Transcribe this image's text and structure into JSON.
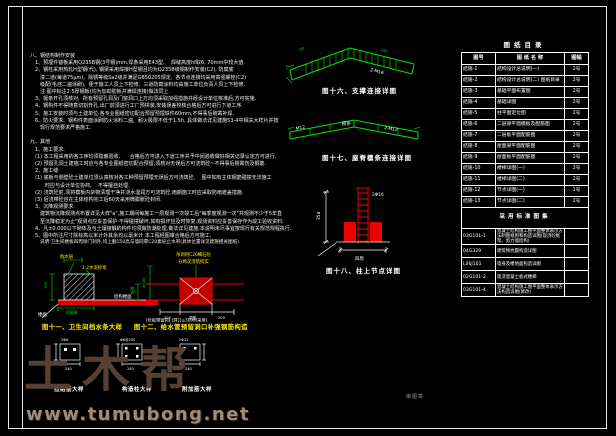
{
  "watermark": {
    "brand": "土木帮",
    "url": "www.tumubong.net"
  },
  "notes": {
    "lines": [
      "八、钢结构制作安装",
      "　1、预埋件锚板采用Q235B钢(3号钢)mm,焊条采用E43型,    焊缝高度hf取6, 70mm中较大值.",
      "　2、钢柱采用热轧H型钢(代), 钢梁采用焊接H型钢且均为Q235B级钢制作安装(C2), 防腐底",
      "　　漆二道(每道75μm),  除锈等级Sa2级并满足GB50205规定,  各节点连接均采用高强螺栓(C2)",
      "　　级配(毛坯二遍涂刷),  便于施工人员上下检修,  三道防腐涂料均由施工单位负责人员上下检修.",
      "　　注:图中标注2.5厚钢板(均为加劲肋板并满焊连接)做法同上.",
      "　3、檩条开孔须核对,  所有预留孔洞及门窗洞口上方均须采取加强措施并经设计单位核准后,方可实施.",
      "　4、钢构件不得随意切割开孔,出厂前须进行工厂预拼装,安装误差校核合格后方可进行下道工序.",
      "　5、施工安装时须与土建单位·各专业图纸密切配合预留预埋铁件60mm,不得事后剔凿补焊.",
      "　6、防火要求:  钢构件表面涂刷防火涂料二遍,  耐火极限不低于1.5h, 具体做法详见建施53-4中相关大样片并按",
      "　　现行规范要求严格施工.",
      "",
      "九、其他",
      "　1、施工要求:",
      "　(1) 本工程采用的各工序均须隐蔽验收,      合格后方可进入下道工序并予中间验收做好相关记录认定方可进行.",
      "　(2) 预留孔洞土建施工时应与各专业图纸密切配合预留,须核对无误后方可浇筑砼~不得事后剔凿伤及钢筋.",
      "　2、施工缝:",
      "　(1) 底板与侧壁砼土建单位须认真核对各工种预留预埋无误后方可浇筑砼,    图中如有主体钢筋碰撞无法施工",
      "　　　时应与设计单位协商,    不得擅自处理.",
      "　(2) 浇筑砼前,须将模板内杂物清理干净并浇水湿润方可浇筑砼,雨期施工时应采取防雨遮盖措施.",
      "　(3) 后浇带砼应在主体结构完工后60天采用微膨胀砼封闭.",
      "　3、沉降观测要求:",
      "　　建筑物沉降观测点布置详见大样\"a\",施工期间每施工一层观测一次竣工后\"每季度观测一次\"共观测不少于5年直",
      "　　至沉降稳定为止\"观测点应妥善保护·不得碰撞破坏,如有损坏应及时恢复,观测资料应妥善保存作为竣工验收资料;",
      "　4、凡±0.000以下砌体及与土壤接触的构件均须做防潮处理,做法详见建施,本说明未尽事宜按现行有关规范规程执行.",
      "　5、图中所注尺寸除标高以米计外其余均以毫米计 本工程经图审合格后方可施工."
    ]
  },
  "figures": {
    "fig16": {
      "caption": "图十六、支撑连接详图",
      "dim_left": "40",
      "dim_right": "240",
      "dim_end": "60",
      "label_right": "2-M16"
    },
    "fig17": {
      "caption": "图十七、屋脊檩条连接详图",
      "label_left": "M12",
      "label_mid": "檩条",
      "label_right": "2-M12"
    },
    "fig18": {
      "caption": "图十八、柱上节点详图",
      "label_top": "2Φ16",
      "dim_left": "35d",
      "dim_bottom": "四周"
    },
    "fig11": {
      "caption": "图十一、卫生间挡水条大样",
      "label_waterproof": "防水层",
      "label_mortar": "1:2水泥砂浆",
      "label_slab": "结构楼面",
      "dim_height": "150",
      "dim_right": "≥300",
      "label_floor": "楼面",
      "dim_width": "同墙厚"
    },
    "fig12": {
      "caption": "图十二、给水管预留洞口补强钢筋构造",
      "label_top1": "吊洞用C20细石砼",
      "label_top2": "分两次浇筑捣实",
      "dim_thickness": "板厚",
      "dim_hole": "洞宽",
      "dim_side_l": "200",
      "dim_side_r": "200",
      "note": "(砼板预留洞) (洞口≤300时采用)"
    },
    "minis": [
      {
        "caption": "拉结筋大样",
        "top_label": "2Φ6",
        "dim": "240"
      },
      {
        "caption": "构造柱大样",
        "top_label": "Φ6@200",
        "dim": "240"
      },
      {
        "caption": "附加筋大样",
        "top_label": "2Φ12",
        "dim": "240"
      }
    ]
  },
  "note6": "说明:卫生间楼板四周除门洞外,均上翻150高与墙同厚C20素砼止水带(具体位置详见建施相关图纸).",
  "stamp": "审图章",
  "table": {
    "title": "图纸目录",
    "headers": [
      "图号",
      "图 纸 名 称",
      "图幅"
    ],
    "rows": [
      {
        "no": "结施-1",
        "name": "结构设计总说明(一)",
        "size": "2号"
      },
      {
        "no": "结施-2",
        "name": "结构设计总说明(二) 图纸目录",
        "size": "2号"
      },
      {
        "no": "结施-3",
        "name": "基础平面布置图",
        "size": "2号"
      },
      {
        "no": "结施-4",
        "name": "基础详图",
        "size": "2号"
      },
      {
        "no": "结施-5",
        "name": "柱平面定位图",
        "size": "2号"
      },
      {
        "no": "结施-6",
        "name": "二层梁平面模板及配筋图",
        "size": "2号"
      },
      {
        "no": "结施-7",
        "name": "二层板平面配筋图",
        "size": "2号"
      },
      {
        "no": "结施-8",
        "name": "屋面梁平面配筋图",
        "size": "2号"
      },
      {
        "no": "结施-9",
        "name": "屋面板平面配筋图",
        "size": "2号"
      },
      {
        "no": "结施-10",
        "name": "楼梯详图(一)",
        "size": "2号"
      },
      {
        "no": "结施-11",
        "name": "楼梯详图(二)",
        "size": "2号"
      },
      {
        "no": "结施-12",
        "name": "节点详图(一)",
        "size": "1号"
      },
      {
        "no": "结施-13",
        "name": "节点详图(二)",
        "size": "2号"
      }
    ],
    "atlas_header": "采用标准图集",
    "atlas_rows": [
      {
        "code": "03G101-1",
        "name": "混凝土结构施工图平面整体表示方法制图规则和构造详图(现浇砼框架、剪力墙结构)"
      },
      {
        "code": "04G329",
        "name": "建筑物抗震构造详图"
      },
      {
        "code": "L06J101",
        "name": "墙身及楼地面构造详图"
      },
      {
        "code": "02G101-2",
        "name": "现浇混凝土板式楼梯"
      },
      {
        "code": "03G101-4",
        "name": "混凝土结构施工图平面整体表示方法构造详图(修改)"
      }
    ]
  },
  "colors": {
    "cad_green": "#00e400",
    "cad_red": "#ee0000",
    "cad_yellow": "#ffee00",
    "line_white": "#f5f5f5",
    "watermark_brown": "#564033"
  }
}
